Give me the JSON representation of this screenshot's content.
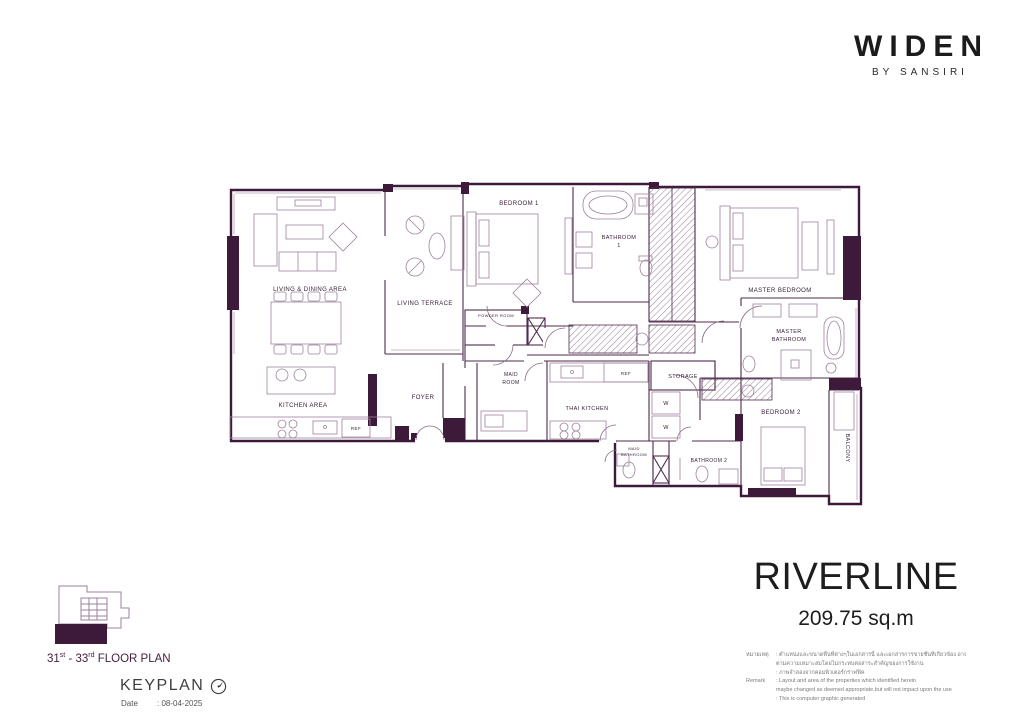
{
  "brand": {
    "name": "WIDEN",
    "byline": "BY SANSIRI"
  },
  "title": {
    "project_name": "RIVERLINE",
    "unit_area": "209.75 sq.m"
  },
  "remark": {
    "thai_label": "หมายเหตุ",
    "thai_line1": ": ตำแหน่งและขนาดพื้นที่ต่างๆในเอกสารนี้ และเอกสารการขายชั้นที่เกี่ยวข้อง อาจปรับเปลี่ยนได้",
    "thai_line2": "ตามความเหมาะสมโดยไม่กระทบต่อสาระสำคัญของการใช้งาน",
    "thai_line3": ": ภาพจำลองจากคอมพิวเตอร์กราฟฟิค",
    "en_label": "Remark",
    "en_line1": ": Layout and area of the properties which identified herein",
    "en_line2": "maybe changed as deemed appropriate,but will not impact upon the use",
    "en_line3": ": This is computer graphic generated"
  },
  "keyplan": {
    "floor_num1": "31",
    "floor_sup1": "st",
    "floor_sep": " - ",
    "floor_num2": "33",
    "floor_sup2": "rd",
    "floor_suffix": " FLOOR PLAN",
    "keyplan_label": "KEYPLAN",
    "date_label": "Date",
    "date_value": ": 08-04-2025"
  },
  "floorplan": {
    "labels": {
      "living_dining": "LIVING & DINING AREA",
      "living_terrace": "LIVING TERRACE",
      "bedroom1": "BEDROOM 1",
      "bathroom1_l1": "BATHROOM",
      "bathroom1_l2": "1",
      "powder_room": "POWDER ROOM",
      "master_bedroom": "MASTER BEDROOM",
      "master_bath_l1": "MASTER",
      "master_bath_l2": "BATHROOM",
      "kitchen_area": "KITCHEN AREA",
      "foyer": "FOYER",
      "maid_l1": "MAID",
      "maid_l2": "ROOM",
      "thai_kitchen": "THAI KITCHEN",
      "storage": "STORAGE",
      "ref_kitchen": "REF",
      "ref_thai": "REF",
      "washer1": "W",
      "washer2": "W",
      "maid_bath_l1": "MAID",
      "maid_bath_l2": "BATHROOM",
      "bathroom2": "BATHROOM 2",
      "bedroom2": "BEDROOM 2",
      "balcony": "BALCONY"
    },
    "colors": {
      "wall": "#3e1a3a",
      "accent": "#46203f",
      "furniture_line": "#9d829d"
    }
  }
}
